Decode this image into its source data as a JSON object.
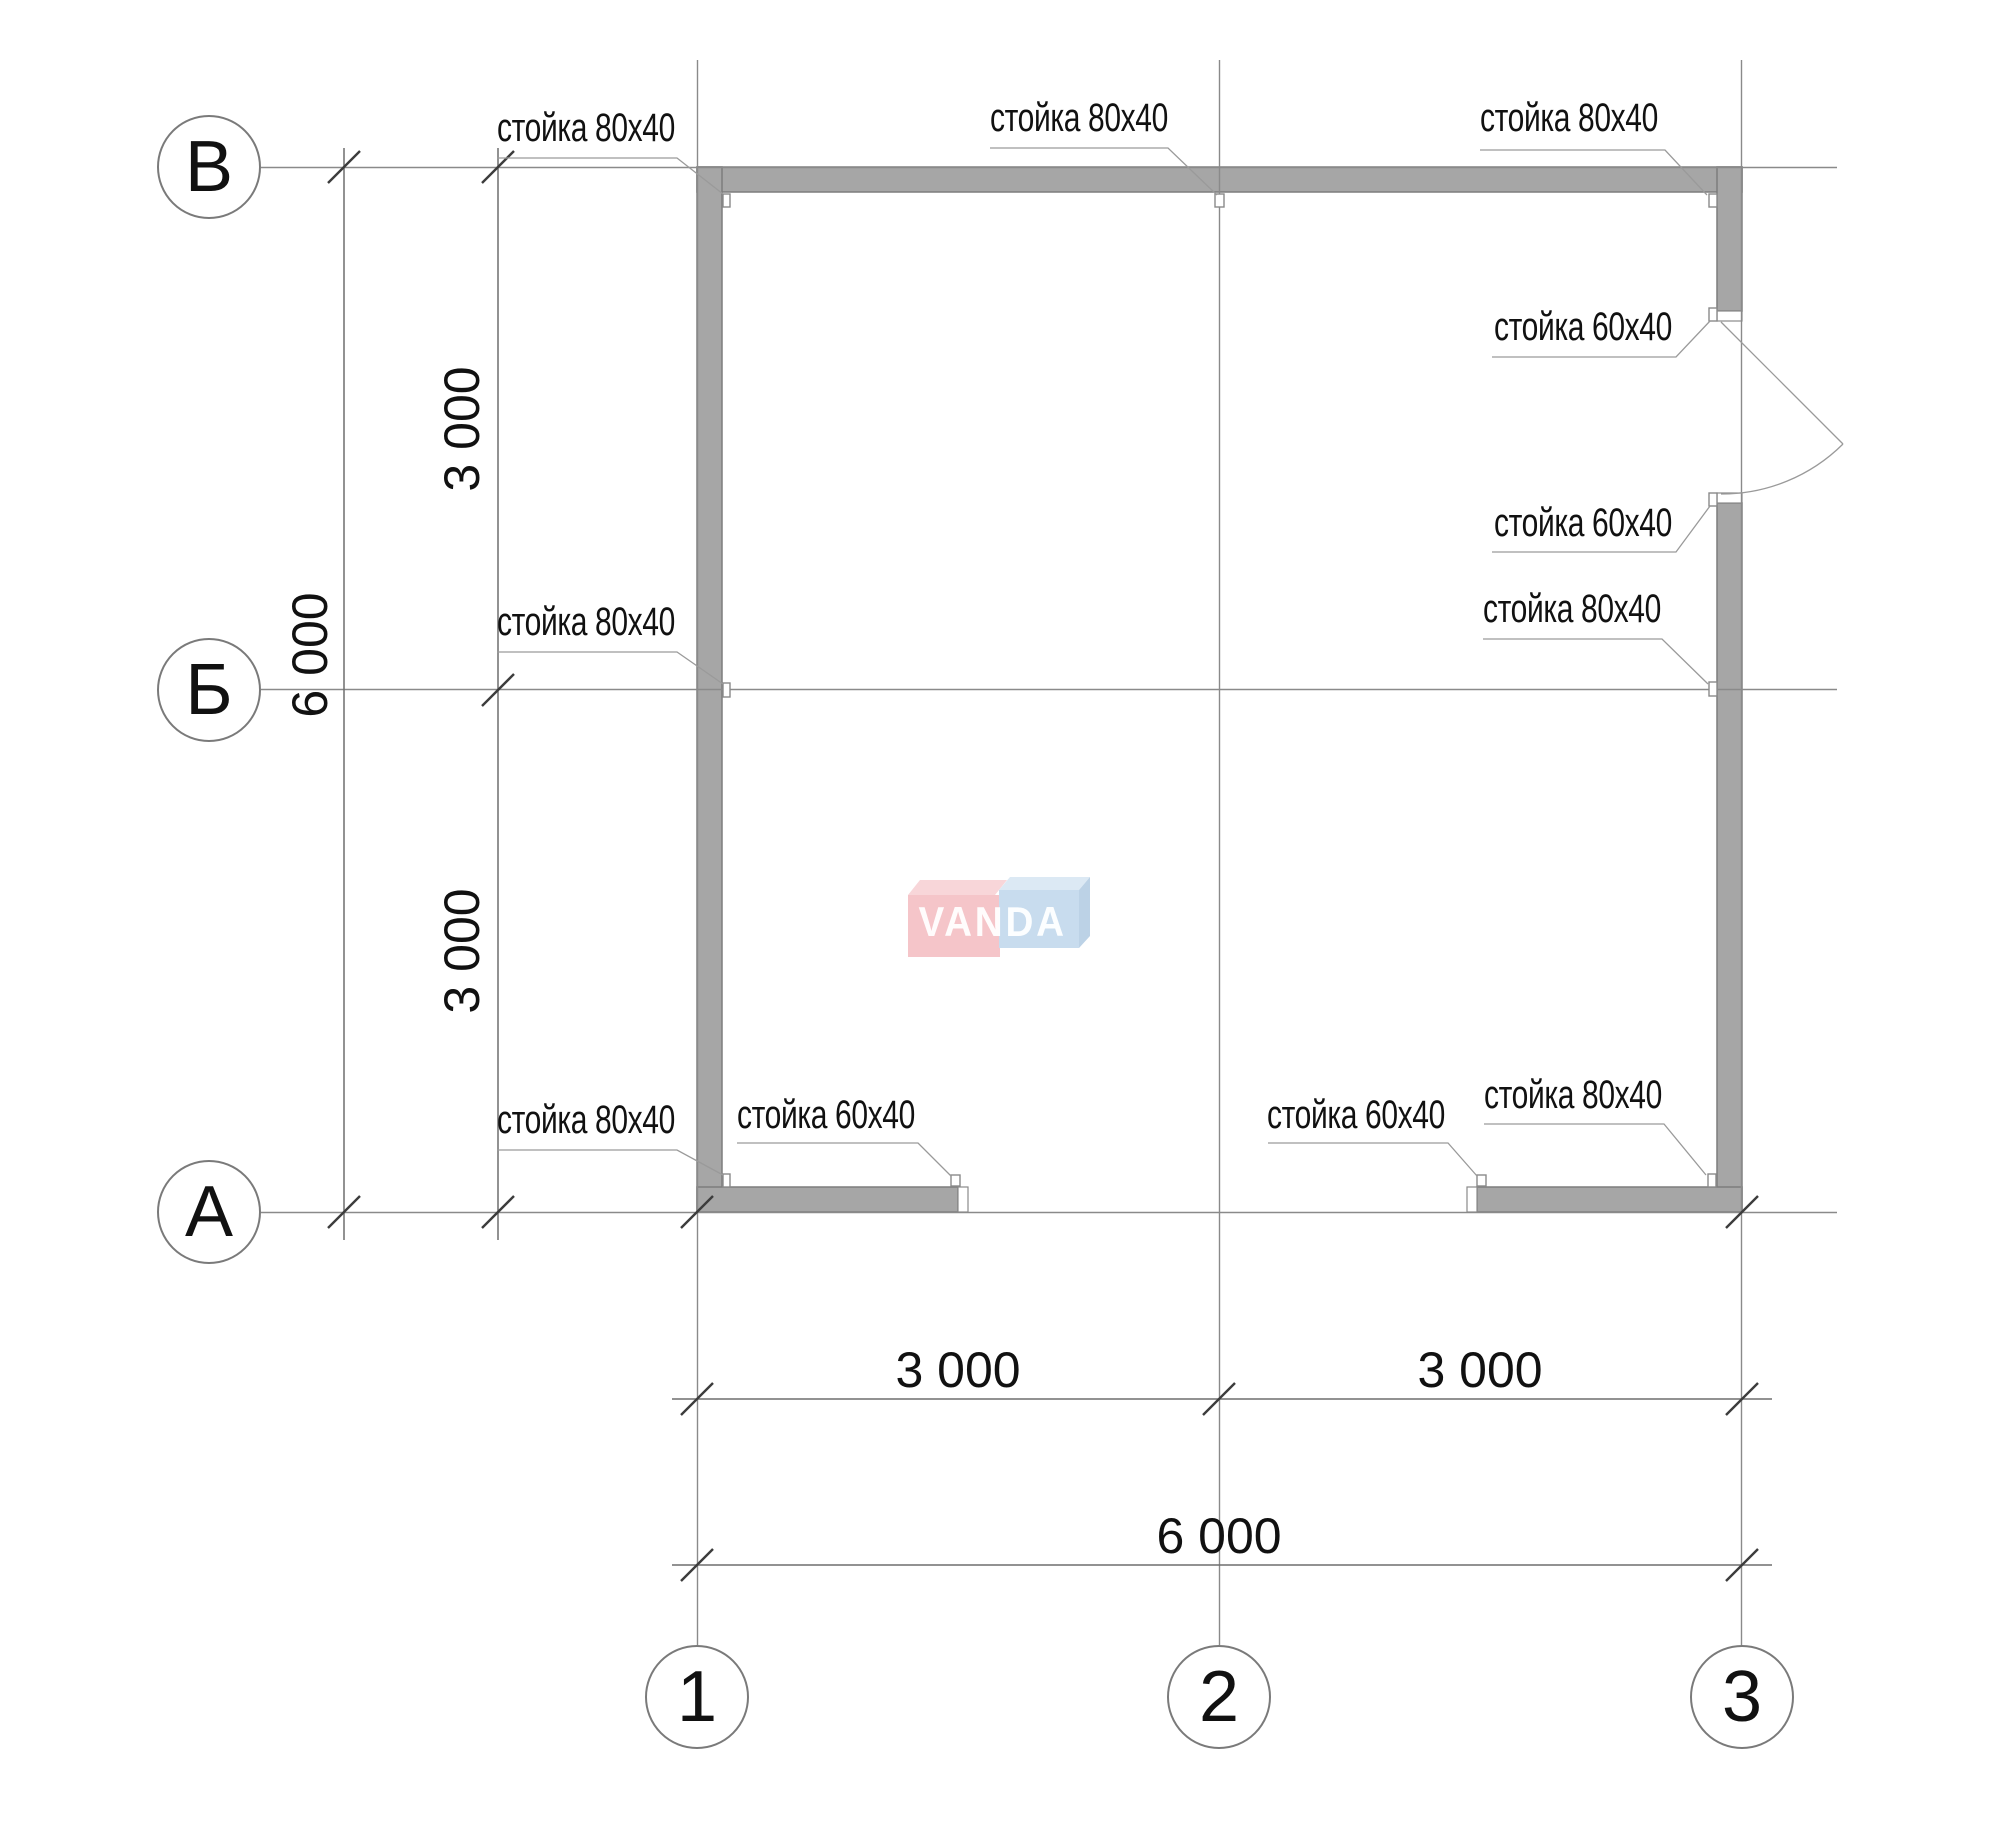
{
  "drawing": {
    "type": "floor-plan frame layout",
    "axis_circles_horizontal": [
      {
        "label": "В"
      },
      {
        "label": "Б"
      },
      {
        "label": "А"
      }
    ],
    "axis_circles_vertical": [
      {
        "label": "1"
      },
      {
        "label": "2"
      },
      {
        "label": "3"
      }
    ],
    "dimensions": {
      "left_span_1": "3 000",
      "left_span_2": "3 000",
      "left_total": "6 000",
      "bottom_span_1": "3 000",
      "bottom_span_2": "3 000",
      "bottom_total": "6 000"
    },
    "stud_labels": {
      "top_left": "стойка 80x40",
      "top_middle": "стойка 80x40",
      "top_right": "стойка 80x40",
      "door_upper": "стойка 60x40",
      "door_lower": "стойка 60x40",
      "middle_left": "стойка 80x40",
      "middle_right": "стойка 80x40",
      "bottom_left": "стойка 80x40",
      "bottom_left_opening": "стойка 60x40",
      "bottom_right_opening": "стойка 60x40",
      "bottom_right": "стойка 80x40"
    },
    "watermark": {
      "text": "VANDA",
      "pink_front": "#f5c5c9",
      "pink_top": "#f8d6d9",
      "blue_front": "#c8dcee",
      "blue_top": "#dce9f4",
      "blue_side": "#bcd2e6"
    },
    "colors": {
      "wall_fill": "#a6a6a6",
      "wall_stroke": "#7d7d7d",
      "grid_line": "#8a8a8a",
      "dimension_line": "#6e6e6e",
      "tick": "#3c3c3c",
      "leader": "#9a9a9a",
      "text": "#1a1a1a"
    }
  }
}
